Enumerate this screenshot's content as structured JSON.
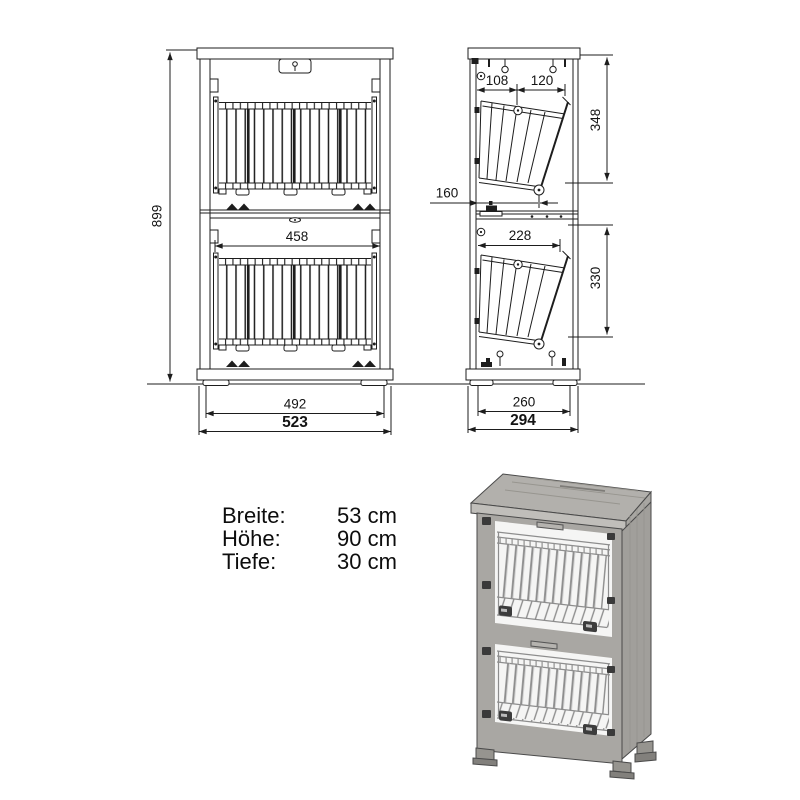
{
  "sheet": {
    "description": "Technical dimension drawing of a two-basket shoe cabinet with 3D product rendering"
  },
  "dims": {
    "front": {
      "height": "899",
      "basket_inner_width": "458",
      "feet_width": "492",
      "total_width": "523"
    },
    "side": {
      "basket_offset": "108",
      "basket_top_width": "120",
      "upper_section_height": "348",
      "pivot_depth": "160",
      "basket_depth": "228",
      "lower_section_height": "330",
      "feet_depth": "260",
      "total_depth": "294"
    }
  },
  "specs": {
    "rows": [
      {
        "label": "Breite:",
        "value": "53 cm"
      },
      {
        "label": "Höhe:",
        "value": "90 cm"
      },
      {
        "label": "Tiefe:",
        "value": "30 cm"
      }
    ]
  },
  "colors": {
    "line": "#1d1d1d",
    "wood_top": "#b2b0ac",
    "wood_front": "#a9a7a3",
    "wood_side": "#a19f9b",
    "interior": "#f5f5f4",
    "hardware": "#3a3a3a",
    "wire": "#8d8d8d"
  }
}
